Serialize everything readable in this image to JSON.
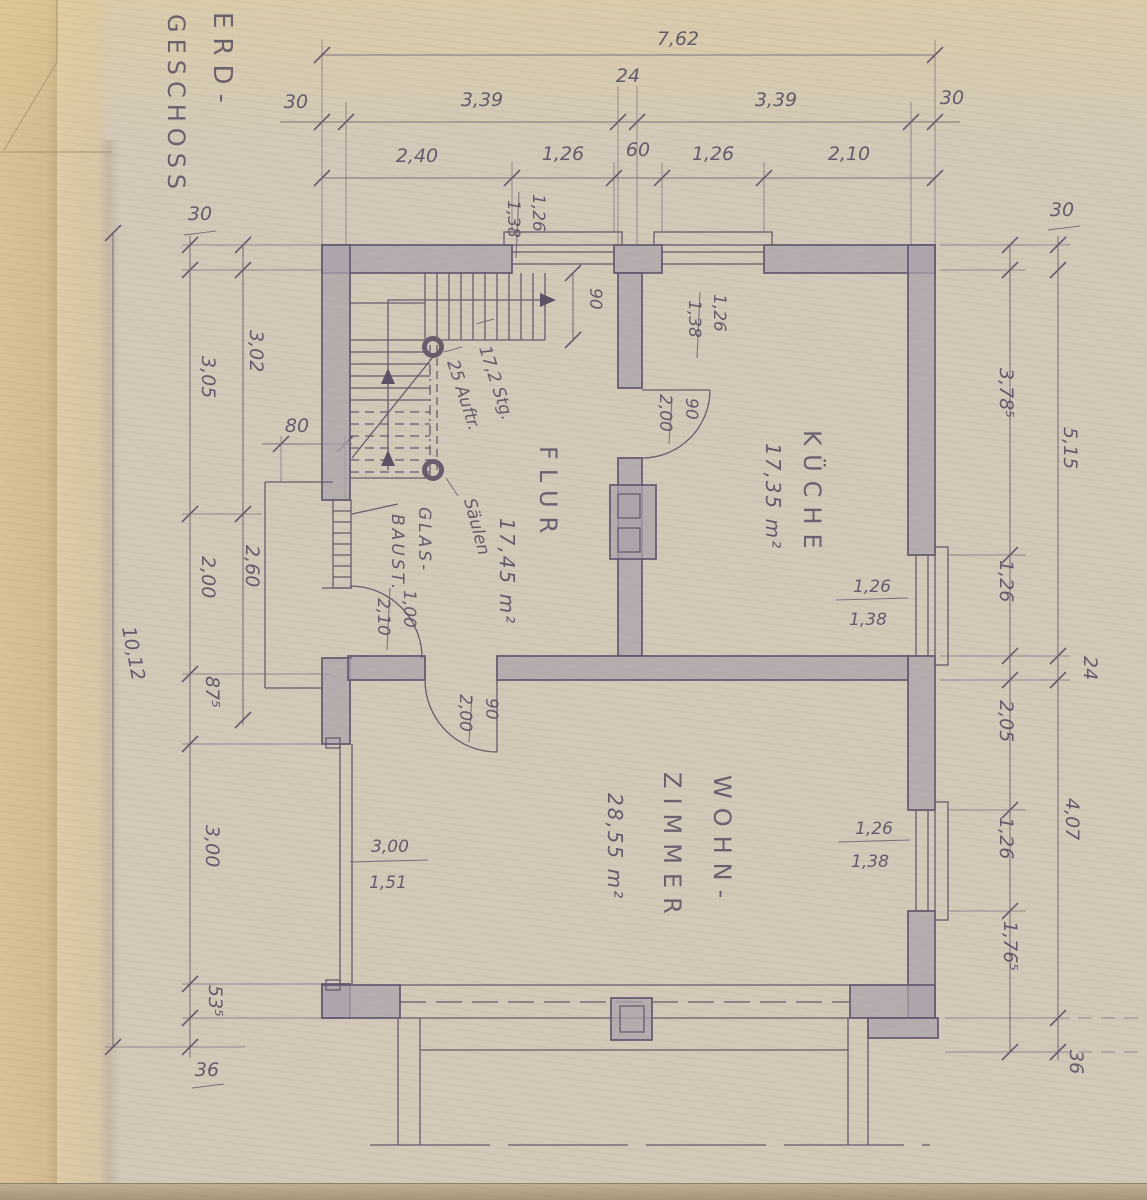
{
  "title": {
    "line1": "ERD-",
    "line2": "GESCHOSS"
  },
  "rooms": {
    "flur": {
      "name": "FLUR",
      "area": "17,45 m²"
    },
    "kueche": {
      "name": "KÜCHE",
      "area": "17,35 m²"
    },
    "wohn": {
      "line1": "WOHN-",
      "line2": "ZIMMER",
      "area": "28,55 m²"
    }
  },
  "stair": {
    "risers": "17,2 Stg.",
    "treads": "25 Auftr.",
    "columns": "Säulen",
    "width": "90"
  },
  "labels": {
    "glass1": "GLAS-",
    "glass2": "BAUST."
  },
  "doors": {
    "entrance": {
      "w": "1,00",
      "h": "2,10"
    },
    "kitchen": {
      "w": "90",
      "h": "2,00"
    },
    "living": {
      "w": "90",
      "h": "2,00"
    }
  },
  "windows": {
    "flur_top": {
      "w": "1,26",
      "h": "1,38"
    },
    "kitchen_top": {
      "w": "1,26",
      "h": "1,38"
    },
    "kitchen_right": {
      "w": "1,26",
      "h": "1,38"
    },
    "living_right": {
      "w": "1,26",
      "h": "1,38"
    },
    "living_left": {
      "w": "3,00",
      "h": "1,51"
    }
  },
  "dims": {
    "top_overall": "7,62",
    "top_row2": [
      "30",
      "3,39",
      "24",
      "3,39",
      "30"
    ],
    "top_row3": [
      "2,40",
      "1,26",
      "60",
      "1,26",
      "2,10"
    ],
    "left_total": "10,12",
    "left_outer": [
      "30",
      "3,05",
      "2,00",
      "87⁵",
      "3,00",
      "53⁵",
      "36"
    ],
    "left_inner": [
      "3,02",
      "2,60"
    ],
    "left_bay": "80",
    "right_inner": [
      "3,78⁵",
      "1,26",
      "2,05",
      "1,26",
      "1,76⁵"
    ],
    "right_wall": "24",
    "right_outer": [
      "30",
      "5,15",
      "4,07",
      "36"
    ]
  }
}
